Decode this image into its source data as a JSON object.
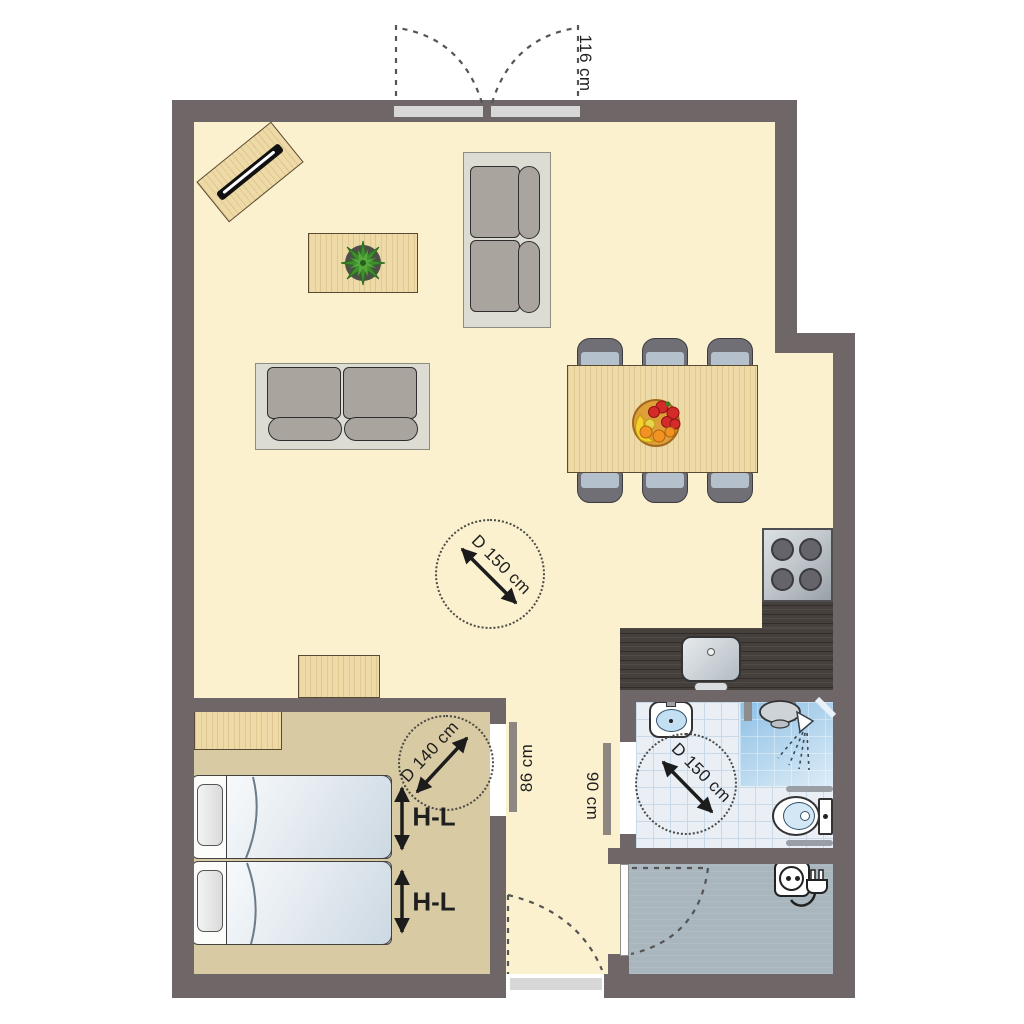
{
  "plan": {
    "type": "apartment-floor-plan",
    "labels": {
      "entry_width": "116 cm",
      "living_circle": "D 150 cm",
      "bedroom_circle": "D 140 cm",
      "bathroom_circle": "D 150 cm",
      "bedroom_door_width": "86 cm",
      "bathroom_door_width": "90 cm",
      "bed_top": "H-L",
      "bed_bottom": "H-L"
    },
    "legend_icons": [
      "double-entry-door",
      "tv-sideboard",
      "coffee-table-plant",
      "sofa-2-seat",
      "sofa-2-seat",
      "dining-table-6-chairs",
      "fruit-bowl",
      "stove-4-burners",
      "kitchen-sink",
      "turning-circle",
      "sideboard",
      "twin-beds",
      "washbasin",
      "shower",
      "toilet",
      "grab-bars",
      "power-outlet-plug",
      "door-swing-arc"
    ],
    "colors": {
      "wall": "#6f6767",
      "floor_living": "#fcf1cf",
      "floor_bedroom": "#d8caa2",
      "floor_bath": "#e9eff5",
      "tile_grid": "#c9d9e8",
      "floor_utility": "#aab6be",
      "counter": "#46403c",
      "wood": "#eedaa6",
      "wood_edge": "#5b4a33",
      "sofa_frame": "#dcdcd2",
      "cushion": "#aaa49e",
      "chair": "#6f6f75",
      "chair_seat": "#b4c0cc",
      "door_leaf": "#d7d7d7",
      "door_open_leaf": "#8e8680",
      "burner": "#64646a",
      "ink": "#1f1f1f"
    }
  }
}
